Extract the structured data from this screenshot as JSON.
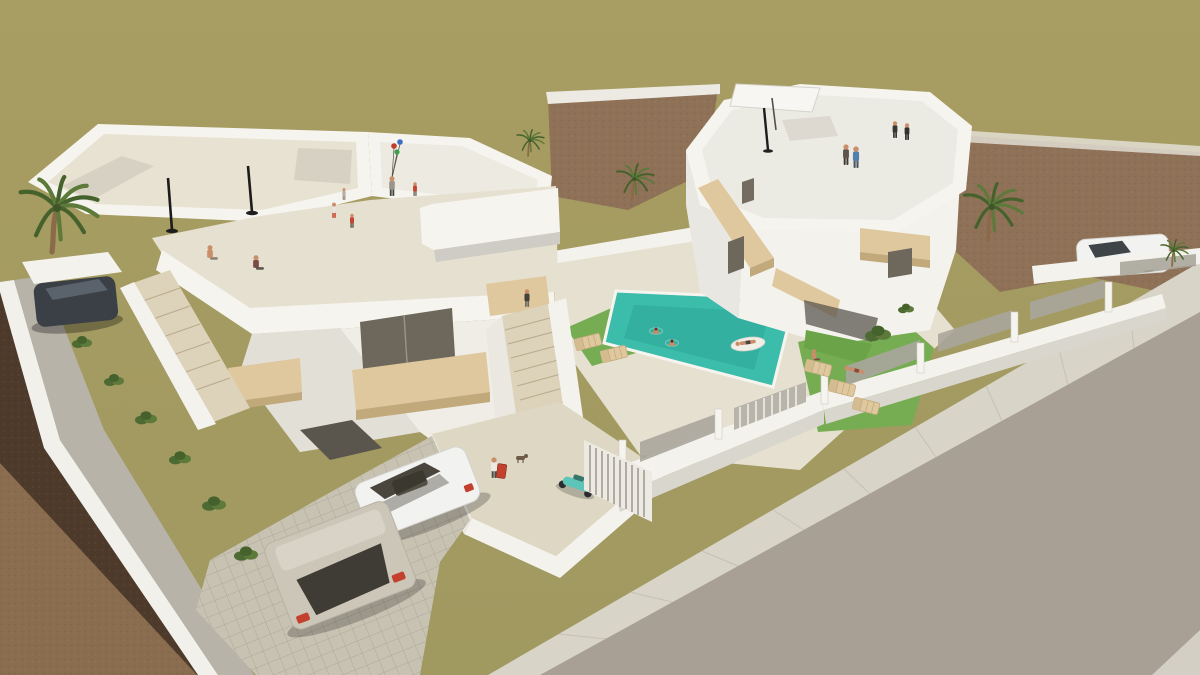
{
  "scene": {
    "type": "3d-architectural-render",
    "description": "Aerial 3D rendering of two modern white villas with rooftop terraces, swimming pool, garden, parked cars, palm trees and people",
    "palette": {
      "field_olive": "#a49b61",
      "dirt_brown": "#8e7157",
      "dirt_dark": "#6d543e",
      "dirt_light": "#8a6c4e",
      "dirt_shadow": "#443327",
      "road_gray": "#a8a094",
      "sidewalk": "#d8d4c8",
      "sidewalk_dark": "#c2beb1",
      "wall_white": "#f4f2ec",
      "wall_shade": "#dcd9d2",
      "wall_dark": "#c2bfb8",
      "roof_cream": "#e8e2d2",
      "terrace_floor": "#e6e0d0",
      "wood_tan": "#dfc89e",
      "wood_tan_dark": "#c2a97c",
      "glass_dark": "#6e675c",
      "pool_teal": "#3cbcaa",
      "pool_teal_dark": "#2ba695",
      "lawn_green": "#76ad52",
      "palm_green": "#5d7a3a",
      "palm_dark": "#46622c",
      "trunk_brown": "#8a6a48",
      "car_white": "#f2f2f0",
      "car_gray": "#ccc6b8",
      "car_dark": "#3a4046",
      "accent_red": "#c4402e",
      "skin": "#c98e6a",
      "scooter_teal": "#5fc4b8",
      "step_beige": "#ddd2ba",
      "courtyard_floor": "#ded7c4",
      "driveway": "#c8c2b2"
    },
    "people": [
      {
        "name": "sitting-man",
        "x": 210,
        "y": 262,
        "pose": "sit",
        "s": 1.05,
        "shirt": "#c98e6a",
        "pants": "#8a8376"
      },
      {
        "name": "sitting-woman",
        "x": 256,
        "y": 272,
        "pose": "sit",
        "s": 1.05,
        "shirt": "#7a4a44",
        "pants": "#5c5650"
      },
      {
        "name": "girl-white-dress",
        "x": 334,
        "y": 218,
        "pose": "stand",
        "s": 0.78,
        "shirt": "#e8e4dc",
        "pants": "#c4452f"
      },
      {
        "name": "boy-red-shirt",
        "x": 352,
        "y": 228,
        "pose": "stand",
        "s": 0.72,
        "shirt": "#c4452f",
        "pants": "#5a544c"
      },
      {
        "name": "toddler",
        "x": 344,
        "y": 200,
        "pose": "stand",
        "s": 0.6,
        "shirt": "#b8b2a6",
        "pants": "#8a8276"
      },
      {
        "name": "balloon-woman",
        "x": 392,
        "y": 196,
        "pose": "stand",
        "s": 1.0,
        "shirt": "#9a948a",
        "pants": "#4a4642"
      },
      {
        "name": "kid-red",
        "x": 415,
        "y": 196,
        "pose": "stand",
        "s": 0.7,
        "shirt": "#c4452f",
        "pants": "#6b655c"
      },
      {
        "name": "roof-woman-right",
        "x": 846,
        "y": 165,
        "pose": "stand",
        "s": 1.05,
        "shirt": "#5f554d",
        "pants": "#3f3a35"
      },
      {
        "name": "roof-man-blue",
        "x": 856,
        "y": 168,
        "pose": "stand",
        "s": 1.1,
        "shirt": "#4f7fae",
        "pants": "#4a5561"
      },
      {
        "name": "roof-figure-a",
        "x": 895,
        "y": 138,
        "pose": "stand",
        "s": 0.85,
        "shirt": "#3a3632",
        "pants": "#2e2b28"
      },
      {
        "name": "roof-figure-b",
        "x": 907,
        "y": 140,
        "pose": "stand",
        "s": 0.85,
        "shirt": "#35322e",
        "pants": "#2a2724"
      },
      {
        "name": "courtyard-traveler",
        "x": 494,
        "y": 478,
        "pose": "stand",
        "s": 1.05,
        "shirt": "#ece9e2",
        "pants": "#4e4a44"
      },
      {
        "name": "stair-walker",
        "x": 527,
        "y": 307,
        "pose": "stand",
        "s": 0.9,
        "shirt": "#44403a",
        "pants": "#6e685f"
      },
      {
        "name": "swimmer-1",
        "x": 656,
        "y": 330,
        "pose": "swim",
        "s": 1,
        "shirt": "#b06a4e",
        "pants": "#5a3c2e"
      },
      {
        "name": "swimmer-2",
        "x": 672,
        "y": 342,
        "pose": "swim",
        "s": 1,
        "shirt": "#8a5a42",
        "pants": "#433028"
      },
      {
        "name": "float-person",
        "x": 748,
        "y": 344,
        "pose": "lie",
        "s": 1,
        "rot": -8,
        "shirt": "#c98e6a",
        "pants": "#4a4440"
      },
      {
        "name": "sunbather-lying",
        "x": 856,
        "y": 372,
        "pose": "lie",
        "s": 1,
        "rot": 14,
        "shirt": "#c98e6a",
        "pants": "#8a4a3e"
      },
      {
        "name": "sunbather-sitting",
        "x": 814,
        "y": 362,
        "pose": "sit",
        "s": 0.8,
        "shirt": "#c98e6a",
        "pants": "#7a4a44"
      }
    ],
    "palms": [
      {
        "name": "palm-left-edge",
        "x": 52,
        "y": 252,
        "s": 2.0
      },
      {
        "name": "palm-small-center",
        "x": 528,
        "y": 156,
        "s": 0.7
      },
      {
        "name": "palm-between-villas",
        "x": 632,
        "y": 200,
        "s": 0.95
      },
      {
        "name": "palm-right-large",
        "x": 988,
        "y": 240,
        "s": 1.5
      },
      {
        "name": "palm-far-right",
        "x": 1172,
        "y": 266,
        "s": 0.7
      }
    ],
    "shrubs": [
      {
        "x": 82,
        "y": 344,
        "s": 1
      },
      {
        "x": 114,
        "y": 382,
        "s": 1
      },
      {
        "x": 146,
        "y": 420,
        "s": 1.1
      },
      {
        "x": 180,
        "y": 460,
        "s": 1.1
      },
      {
        "x": 214,
        "y": 506,
        "s": 1.2
      },
      {
        "x": 246,
        "y": 556,
        "s": 1.2
      },
      {
        "x": 878,
        "y": 336,
        "s": 1.3
      },
      {
        "x": 906,
        "y": 310,
        "s": 0.8
      }
    ],
    "loungers": [
      {
        "x": 588,
        "y": 342,
        "r": -14
      },
      {
        "x": 614,
        "y": 354,
        "r": -14
      },
      {
        "x": 818,
        "y": 368,
        "r": 14
      },
      {
        "x": 842,
        "y": 388,
        "r": 14
      },
      {
        "x": 866,
        "y": 406,
        "r": 14
      }
    ]
  }
}
